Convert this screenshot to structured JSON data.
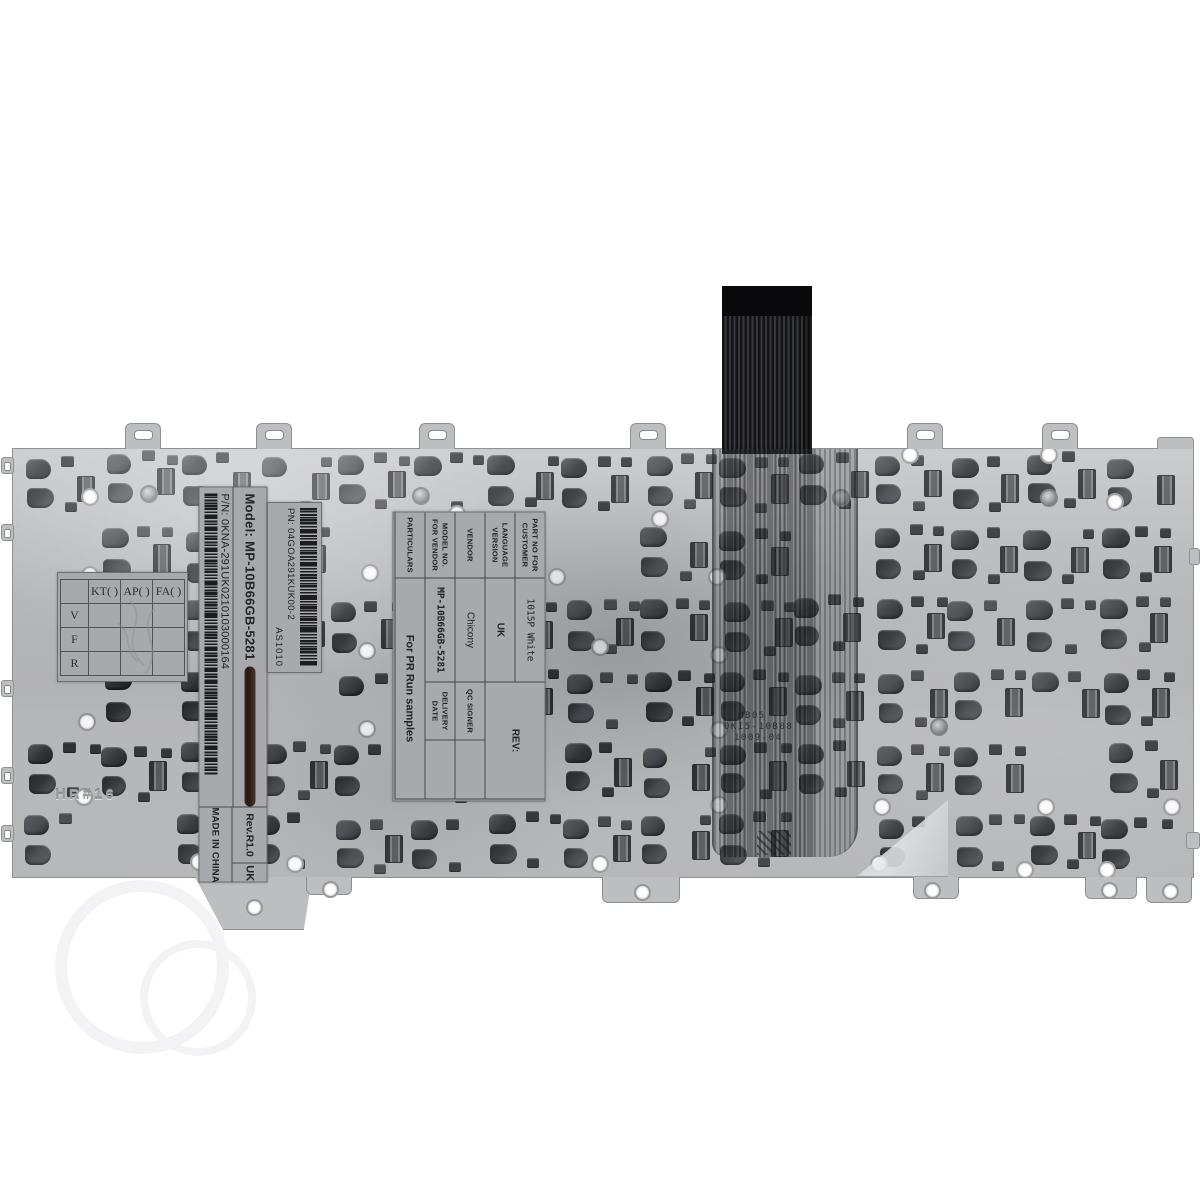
{
  "stickers": {
    "model_label": {
      "model": "Model: MP-10B66GB-5281",
      "pn": "P/N: 0KNA-291UK0210103000164",
      "rev": "Rev.R1.0",
      "language": "UK",
      "made_in": "MADE IN CHINA"
    },
    "pn_label": {
      "pn": "PN: 04GOA291KUK00-2",
      "code": "AS1010"
    },
    "spec_label": {
      "rows": [
        {
          "label": "PART NO FOR CUSTOMER",
          "value": "1015P White"
        },
        {
          "label": "LANGUAGE VERSION",
          "value": "UK"
        },
        {
          "label": "VENDOR",
          "value": "Chicony"
        },
        {
          "label": "MODEL NO. FOR VENDOR",
          "value": "MP-10B66GB-5281"
        },
        {
          "label": "PARTICULARS",
          "value": "For PR Run samples"
        }
      ],
      "rev_label": "REV:",
      "qc_label": "QC SIGNER",
      "delivery_label": "DELIVERY DATE"
    },
    "qc_grid": {
      "col_headers": [
        "KT( )",
        "AP( )",
        "FA( )"
      ],
      "row_headers": [
        "V",
        "F",
        "R"
      ]
    }
  },
  "plate": {
    "etched_text": "HR#16",
    "membrane_print": [
      "MB05",
      "0KI5-10B88",
      "1009-04"
    ]
  },
  "colors": {
    "background": "#ffffff",
    "plate": "#b9babc",
    "sticker": "#a8a9ac",
    "clip": "#35363a",
    "cable": "#1b1b1e"
  }
}
